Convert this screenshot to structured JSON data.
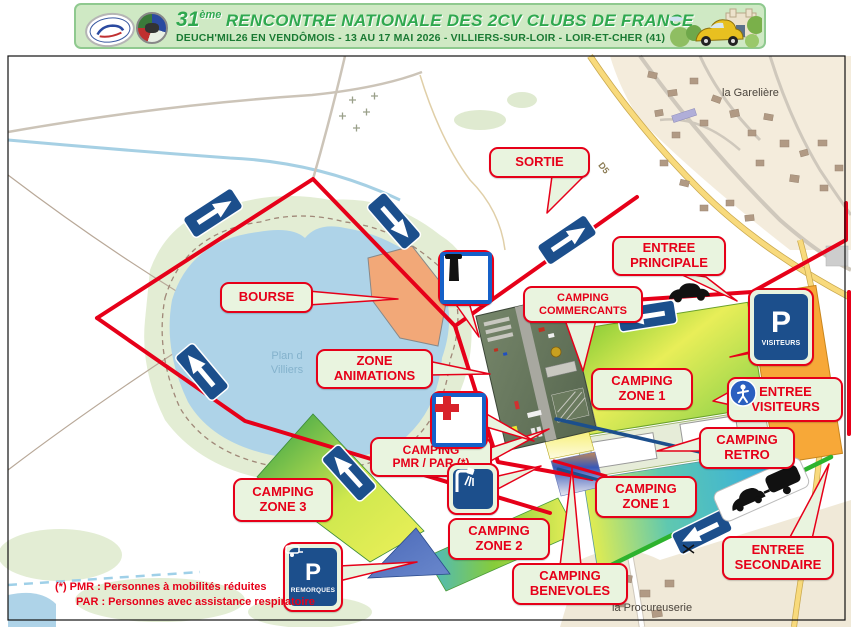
{
  "banner": {
    "edition": "31",
    "edition_sup": "ème",
    "title": "RENCONTRE NATIONALE DES 2CV CLUBS DE FRANCE",
    "subtitle": "DEUCH'MIL26 EN VENDÔMOIS - 13 AU 17 MAI 2026 - VILLIERS-SUR-LOIR - LOIR-ET-CHER (41)"
  },
  "map": {
    "places": {
      "gareliere": "la Garelière",
      "procureuserie": "la Procureuserie",
      "lake_name": "Plan d\nVilliers",
      "road_d5": "D5"
    },
    "callouts": {
      "sortie": "SORTIE",
      "entree_principale": "ENTREE\nPRINCIPALE",
      "camping_commercants": "CAMPING\nCOMMERCANTS",
      "bourse": "BOURSE",
      "zone_animations": "ZONE\nANIMATIONS",
      "camping_zone1_a": "CAMPING\nZONE 1",
      "entree_visiteurs": "ENTREE\nVISITEURS",
      "camping_retro": "CAMPING\nRETRO",
      "camping_zone1_b": "CAMPING\nZONE 1",
      "camping_pmr": "CAMPING\nPMR / PAR (*)",
      "camping_zone3": "CAMPING\nZONE 3",
      "camping_zone2": "CAMPING\nZONE 2",
      "camping_benevoles": "CAMPING\nBENEVOLES",
      "entree_secondaire": "ENTREE\nSECONDAIRE"
    },
    "signs": {
      "parking_visiteurs_p": "P",
      "parking_visiteurs_label": "VISITEURS",
      "parking_remorques_p": "P",
      "parking_remorques_label": "REMORQUES"
    },
    "footnote_line1": "(*) PMR : Personnes à mobilités réduites",
    "footnote_line2": "PAR : Personnes avec assistance respiratoire",
    "colors": {
      "route_red": "#e60019",
      "callout_bg": "#e9f4df",
      "sign_navy": "#1c4f8c",
      "secondary_green": "#2db32d",
      "parking_orange": "#f7a838"
    }
  }
}
